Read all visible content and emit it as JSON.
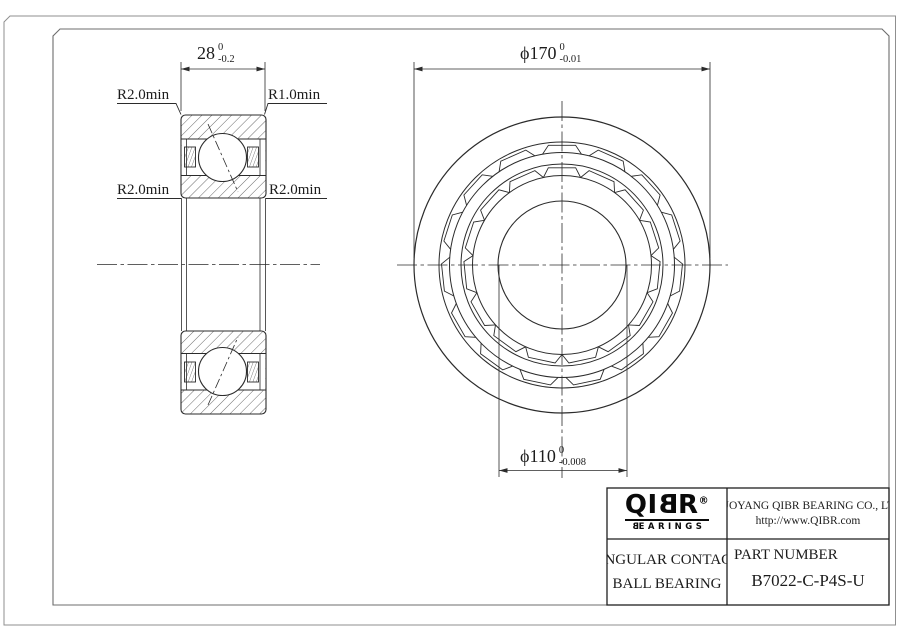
{
  "section_view": {
    "width_dim": {
      "value": "28",
      "tol_upper": "0",
      "tol_lower": "-0.2"
    },
    "fillet_labels": {
      "top_left": "R2.0min",
      "top_right": "R1.0min",
      "mid_left": "R2.0min",
      "mid_right": "R2.0min"
    }
  },
  "front_view": {
    "od_dim": {
      "prefix": "ϕ",
      "value": "170",
      "tol_upper": "0",
      "tol_lower": "-0.01"
    },
    "bore_dim": {
      "prefix": "ϕ",
      "value": "110",
      "tol_upper": "0",
      "tol_lower": "-0.008"
    }
  },
  "title_block": {
    "logo": {
      "prefix": "QI",
      "flipped_letter": "B",
      "suffix": "R",
      "registered": "®",
      "sub_flipped": "B",
      "sub_rest": "EARINGS"
    },
    "company": {
      "name": "LUOYANG QIBR BEARING CO., LTD",
      "url": "http://www.QIBR.com"
    },
    "description": {
      "line1": "ANGULAR CONTACT",
      "line2": "BALL BEARING"
    },
    "part": {
      "label": "PART NUMBER",
      "number": "B7022-C-P4S-U"
    }
  }
}
